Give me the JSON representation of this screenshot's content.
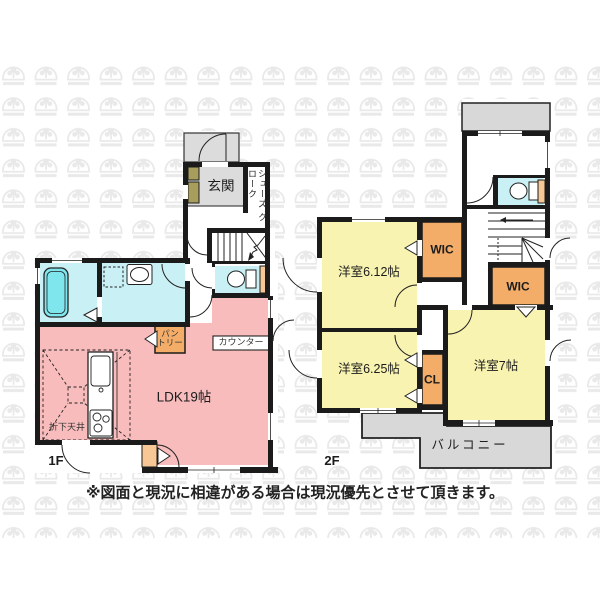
{
  "floor1": {
    "floor_label": "1F",
    "rooms": {
      "genkan": "玄関",
      "shoes_cloak": "シューズクローク",
      "shoes_cloak_lines": [
        "シューズ",
        "クローク"
      ],
      "ldk": "LDK19帖",
      "pantry": "パントリー",
      "pantry_lines": [
        "パン",
        "トリー"
      ],
      "counter": "カウンター",
      "lowered_ceiling": "折下天井"
    }
  },
  "floor2": {
    "floor_label": "2F",
    "rooms": {
      "bedroom_612": "洋室6.12帖",
      "wic_a": "WIC",
      "wic_b": "WIC",
      "bedroom_625": "洋室6.25帖",
      "closet": "CL",
      "bedroom_7": "洋室7帖",
      "balcony": "バルコニー"
    }
  },
  "note": "※図面と現況に相違がある場合は現況優先とさせて頂きます。",
  "palette": {
    "wall": "#1b1b1b",
    "ldk_pink": "#f8bcbc",
    "bedroom_yellow": "#f8f3b0",
    "wet_cyan": "#c9f0f4",
    "bathtub_cyan": "#7fe6ee",
    "closet_orange": "#f3ad68",
    "shelf_orange": "#f7c896",
    "cabinet_olive": "#a79d5d",
    "porch_gray": "#dcdcdc",
    "balcony_gray": "#d8d8d8",
    "watermark_gray": "#e9e9e9",
    "text": "#1c1c1c"
  }
}
